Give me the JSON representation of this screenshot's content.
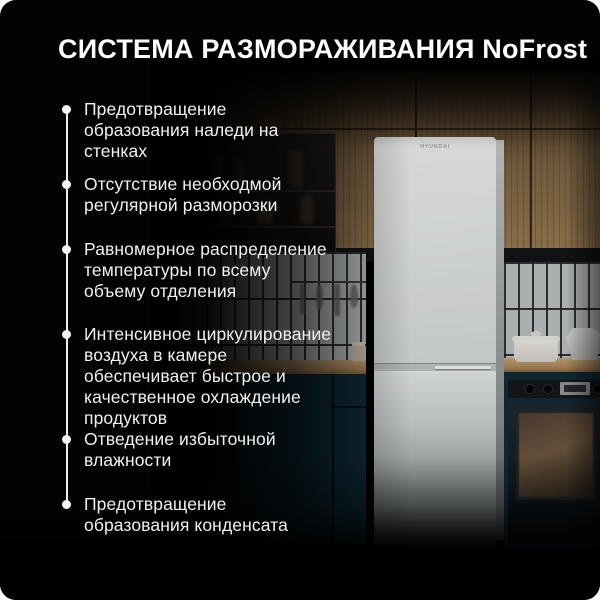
{
  "header": {
    "title": "СИСТЕМА РАЗМОРАЖИВАНИЯ NoFrost"
  },
  "features": [
    {
      "text": "Предотвращение образования наледи на стенках"
    },
    {
      "text": "Отсутствие необходмой регулярной разморозки"
    },
    {
      "text": "Равномерное распределение температуры по всему объему отделения"
    },
    {
      "text": "Интенсивное циркулирование воздуха в камере обеспечивает быстрое и качественное охлаждение продуктов"
    },
    {
      "text": "Отведение избыточной влажности"
    },
    {
      "text": "Предотвращение образования конденсата"
    }
  ],
  "photo": {
    "fridge_brand": "HYUNDAI",
    "description_colors": {
      "background": "#030303",
      "text": "#f0f0f0",
      "cabinet_teal": "#0f2d3c",
      "wood": "#9a7c54"
    }
  }
}
